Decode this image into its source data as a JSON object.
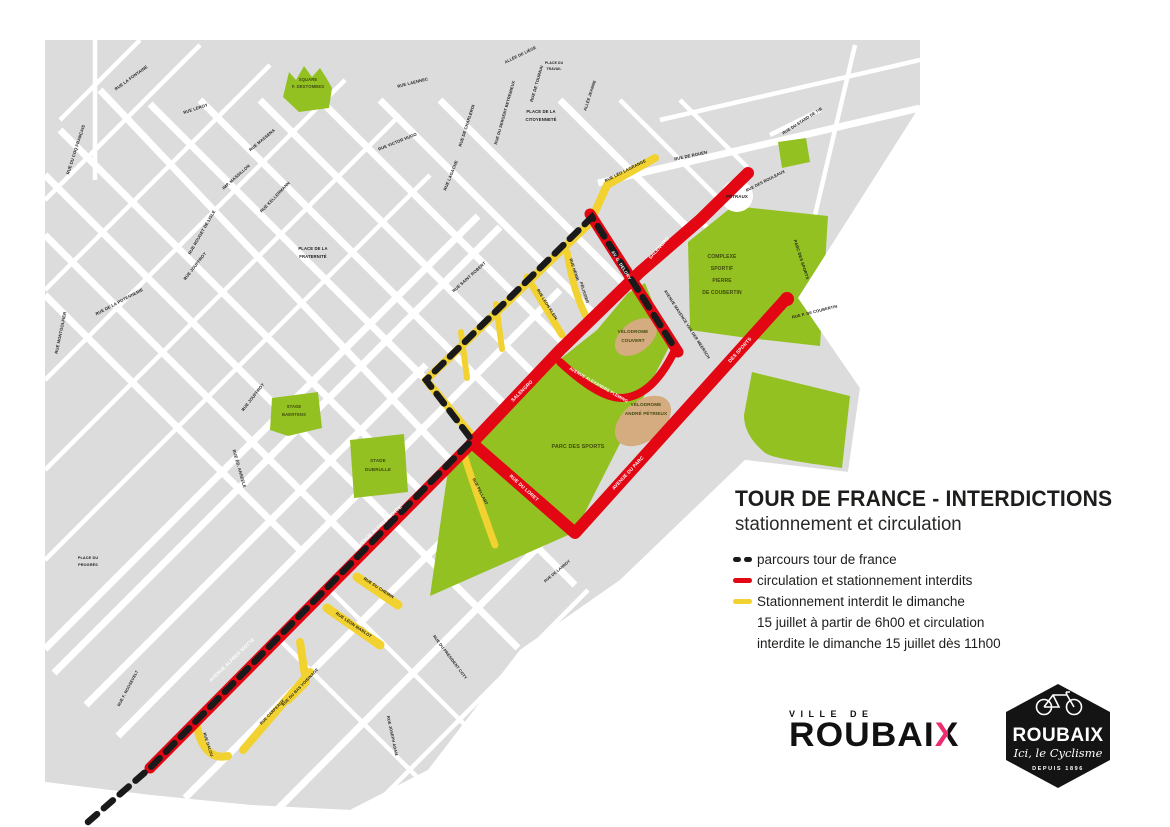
{
  "header": {
    "title": "TOUR DE FRANCE - INTERDICTIONS",
    "subtitle": "stationnement et circulation"
  },
  "legend": {
    "items": [
      {
        "swatch": "dash",
        "label": "parcours tour de france"
      },
      {
        "swatch": "red",
        "label": "circulation et stationnement interdits"
      },
      {
        "swatch": "yellow",
        "lines": [
          "Stationnement interdit le dimanche",
          "15 juillet à partir de 6h00 et circulation",
          "interdite le dimanche 15 juillet dès 11h00"
        ]
      }
    ]
  },
  "logos": {
    "ville": {
      "prefix": "VILLE DE",
      "word": "ROUBAI",
      "x": "X"
    },
    "badge": {
      "name": "ROUBAIX",
      "tagline": "Ici, le Cyclisme",
      "since": "DEPUIS 1896"
    }
  },
  "colors": {
    "red": "#e30613",
    "yellow": "#f2d230",
    "green": "#94c122",
    "tan": "#d5ab80",
    "gray": "#dcdcdc",
    "ink": "#1d1d1b",
    "pink": "#ec2d72",
    "dash": "#1a1a1a"
  },
  "map": {
    "labels": [
      {
        "t": "SQUARE",
        "x": 308,
        "y": 81,
        "r": 0,
        "c": "g",
        "s": 4.2
      },
      {
        "t": "F. DESTOMBES",
        "x": 308,
        "y": 88,
        "r": 0,
        "c": "g",
        "s": 4.2
      },
      {
        "t": "COMPLEXE",
        "x": 722,
        "y": 258,
        "r": 0,
        "c": "g",
        "s": 5
      },
      {
        "t": "SPORTIF",
        "x": 722,
        "y": 270,
        "r": 0,
        "c": "g",
        "s": 5
      },
      {
        "t": "PIERRE",
        "x": 722,
        "y": 282,
        "r": 0,
        "c": "g",
        "s": 5
      },
      {
        "t": "DE COUBERTIN",
        "x": 722,
        "y": 294,
        "r": 0,
        "c": "g",
        "s": 5
      },
      {
        "t": "VÉLODROME",
        "x": 633,
        "y": 333,
        "r": 0,
        "c": "g",
        "s": 4.6
      },
      {
        "t": "COUVERT",
        "x": 633,
        "y": 342,
        "r": 0,
        "c": "g",
        "s": 4.6
      },
      {
        "t": "VÉLODROME",
        "x": 646,
        "y": 406,
        "r": 0,
        "c": "g",
        "s": 4.6
      },
      {
        "t": "ANDRÉ PÉTRIEUX",
        "x": 646,
        "y": 415,
        "r": 0,
        "c": "g",
        "s": 4.6
      },
      {
        "t": "PARC DES SPORTS",
        "x": 578,
        "y": 448,
        "r": 0,
        "c": "g",
        "s": 5.4
      },
      {
        "t": "STADE",
        "x": 294,
        "y": 408,
        "r": 0,
        "c": "g",
        "s": 4.2
      },
      {
        "t": "BAERTENS",
        "x": 294,
        "y": 416,
        "r": 0,
        "c": "g",
        "s": 4.2
      },
      {
        "t": "STADE",
        "x": 378,
        "y": 462,
        "r": 0,
        "c": "g",
        "s": 4.6
      },
      {
        "t": "DUBRULLE",
        "x": 378,
        "y": 471,
        "r": 0,
        "c": "g",
        "s": 4.6
      },
      {
        "t": "PLACE DE LA",
        "x": 541,
        "y": 113,
        "r": 0,
        "c": "k",
        "s": 4.2
      },
      {
        "t": "CITOYENNETÉ",
        "x": 541,
        "y": 121,
        "r": 0,
        "c": "k",
        "s": 4.2
      },
      {
        "t": "PLACE DE LA",
        "x": 313,
        "y": 250,
        "r": 0,
        "c": "k",
        "s": 4.2
      },
      {
        "t": "FRATERNITÉ",
        "x": 313,
        "y": 258,
        "r": 0,
        "c": "k",
        "s": 4.2
      },
      {
        "t": "PLACE DU",
        "x": 88,
        "y": 559,
        "r": 0,
        "c": "k",
        "s": 3.8
      },
      {
        "t": "PROGRÈS",
        "x": 88,
        "y": 566,
        "r": 0,
        "c": "k",
        "s": 3.8
      },
      {
        "t": "PLACE DU",
        "x": 554,
        "y": 64,
        "r": 0,
        "c": "k",
        "s": 3.4
      },
      {
        "t": "TRAVAIL",
        "x": 554,
        "y": 70,
        "r": 0,
        "c": "k",
        "s": 3.4
      },
      {
        "t": "PÉTRAUX",
        "x": 737,
        "y": 198,
        "r": 0,
        "c": "k",
        "s": 4.4
      },
      {
        "t": "AVENUE ALFRED MOTTE",
        "x": 233,
        "y": 661,
        "r": -44,
        "c": "w",
        "s": 4.8
      },
      {
        "t": "AVENUE ALFRED MOTTE",
        "x": 380,
        "y": 528,
        "r": -43,
        "c": "w",
        "s": 4.8
      },
      {
        "t": "SALENGRO",
        "x": 523,
        "y": 392,
        "r": -45,
        "c": "w",
        "s": 4.8
      },
      {
        "t": "SALENGRO",
        "x": 660,
        "y": 249,
        "r": -48,
        "c": "w",
        "s": 4.8
      },
      {
        "t": "AV. G. DELORY",
        "x": 620,
        "y": 266,
        "r": 58,
        "c": "w",
        "s": 4.4
      },
      {
        "t": "RUE DU LORET",
        "x": 523,
        "y": 489,
        "r": 42,
        "c": "w",
        "s": 4.8
      },
      {
        "t": "AVENUE DU PARC",
        "x": 629,
        "y": 474,
        "r": -47,
        "c": "w",
        "s": 4.8
      },
      {
        "t": "DES SPORTS",
        "x": 741,
        "y": 351,
        "r": -48,
        "c": "w",
        "s": 4.8
      },
      {
        "t": "AVENUE ALEXANDRE FLEMING",
        "x": 598,
        "y": 386,
        "r": 30,
        "c": "w",
        "s": 4.2
      },
      {
        "t": "RUE DU COQ FRANÇAIS",
        "x": 77,
        "y": 150,
        "r": -72,
        "c": "k",
        "s": 4.2
      },
      {
        "t": "RUE LA FONTAINE",
        "x": 132,
        "y": 79,
        "r": -36,
        "c": "k",
        "s": 4.2
      },
      {
        "t": "RUE LEROY",
        "x": 196,
        "y": 110,
        "r": -18,
        "c": "k",
        "s": 4.2
      },
      {
        "t": "RUE MASSENA",
        "x": 263,
        "y": 141,
        "r": -40,
        "c": "k",
        "s": 4.2
      },
      {
        "t": "IMP. MASSILLON",
        "x": 237,
        "y": 178,
        "r": -42,
        "c": "k",
        "s": 4.2
      },
      {
        "t": "RUE KELLERMANN",
        "x": 276,
        "y": 198,
        "r": -46,
        "c": "k",
        "s": 4.2
      },
      {
        "t": "RUE ROUGET DE LISLE",
        "x": 203,
        "y": 233,
        "r": -60,
        "c": "k",
        "s": 4.2
      },
      {
        "t": "RUE JOUFFROY",
        "x": 196,
        "y": 267,
        "r": -52,
        "c": "k",
        "s": 4.2
      },
      {
        "t": "RUE JOUFFROY",
        "x": 254,
        "y": 398,
        "r": -52,
        "c": "k",
        "s": 4.2
      },
      {
        "t": "RUE MONTGOLFIER",
        "x": 62,
        "y": 333,
        "r": -78,
        "c": "k",
        "s": 4.2
      },
      {
        "t": "RUE DE LA POTENNERIE",
        "x": 120,
        "y": 303,
        "r": -28,
        "c": "k",
        "s": 4.2
      },
      {
        "t": "RUE VICTOR HUGO",
        "x": 398,
        "y": 143,
        "r": -22,
        "c": "k",
        "s": 4.2
      },
      {
        "t": "RUE LAENNEC",
        "x": 413,
        "y": 84,
        "r": -14,
        "c": "k",
        "s": 4.2
      },
      {
        "t": "RUE DE CHARLEROI",
        "x": 468,
        "y": 126,
        "r": -72,
        "c": "k",
        "s": 4.2
      },
      {
        "t": "RUE DU SERGENT BETREMIEUX",
        "x": 506,
        "y": 113,
        "r": -74,
        "c": "k",
        "s": 4
      },
      {
        "t": "RUE DE TOURNAI",
        "x": 538,
        "y": 84,
        "r": -74,
        "c": "k",
        "s": 4.2
      },
      {
        "t": "ALLÉE DE LIÈGE",
        "x": 521,
        "y": 56,
        "r": -26,
        "c": "k",
        "s": 4
      },
      {
        "t": "ALLÉE JEANNE",
        "x": 591,
        "y": 96,
        "r": -72,
        "c": "k",
        "s": 4
      },
      {
        "t": "RUE LAGACHE",
        "x": 452,
        "y": 176,
        "r": -68,
        "c": "k",
        "s": 4.2
      },
      {
        "t": "RUE SAINT ROBERT",
        "x": 470,
        "y": 278,
        "r": -42,
        "c": "k",
        "s": 4.2
      },
      {
        "t": "RUE HENRI",
        "x": 573,
        "y": 270,
        "r": 72,
        "c": "k",
        "s": 4
      },
      {
        "t": "PÉLISSIER",
        "x": 583,
        "y": 293,
        "r": 72,
        "c": "k",
        "s": 4
      },
      {
        "t": "RUE LÉON KLEIN",
        "x": 546,
        "y": 305,
        "r": 58,
        "c": "k",
        "s": 4
      },
      {
        "t": "RUE LÉO LAGRANGE",
        "x": 626,
        "y": 172,
        "r": -27,
        "c": "k",
        "s": 4.2
      },
      {
        "t": "RUE DE ROUEN",
        "x": 691,
        "y": 157,
        "r": -12,
        "c": "k",
        "s": 4.2
      },
      {
        "t": "AVENUE MAXENCE VAN DER MEERSCH",
        "x": 686,
        "y": 325,
        "r": 57,
        "c": "k",
        "s": 4
      },
      {
        "t": "RUE DU STAND DE TIR",
        "x": 803,
        "y": 122,
        "r": -33,
        "c": "k",
        "s": 4
      },
      {
        "t": "RUE DES BOULEAUX",
        "x": 766,
        "y": 182,
        "r": -27,
        "c": "k",
        "s": 4
      },
      {
        "t": "PARC DES SPORTS",
        "x": 800,
        "y": 260,
        "r": 72,
        "c": "k",
        "s": 4.2
      },
      {
        "t": "RUE P. DE COUBERTIN",
        "x": 815,
        "y": 313,
        "r": -14,
        "c": "k",
        "s": 4
      },
      {
        "t": "RUE ÉD. ANSEELE",
        "x": 238,
        "y": 469,
        "r": 74,
        "c": "k",
        "s": 4.2
      },
      {
        "t": "RUE PELLART",
        "x": 479,
        "y": 492,
        "r": 63,
        "c": "k",
        "s": 4
      },
      {
        "t": "RUE DU CHEMIN",
        "x": 378,
        "y": 589,
        "r": 33,
        "c": "k",
        "s": 4.2
      },
      {
        "t": "RUE LÉON MARLOT",
        "x": 353,
        "y": 626,
        "r": 34,
        "c": "k",
        "s": 4.2
      },
      {
        "t": "RUE DU PRÉSIDENT COTY",
        "x": 449,
        "y": 658,
        "r": 53,
        "c": "k",
        "s": 4
      },
      {
        "t": "RUE JOSEPH ADAM",
        "x": 391,
        "y": 736,
        "r": 78,
        "c": "k",
        "s": 4
      },
      {
        "t": "RUE F. ROOSEVELT",
        "x": 129,
        "y": 689,
        "r": -62,
        "c": "k",
        "s": 4
      },
      {
        "t": "RUE DU BAS VOISINAGE",
        "x": 301,
        "y": 688,
        "r": -46,
        "c": "k",
        "s": 4
      },
      {
        "t": "RUE CARPEAUX",
        "x": 273,
        "y": 713,
        "r": -46,
        "c": "k",
        "s": 4
      },
      {
        "t": "RUE DALOU",
        "x": 207,
        "y": 745,
        "r": 72,
        "c": "k",
        "s": 4
      },
      {
        "t": "RUE DE LANNOY",
        "x": 558,
        "y": 572,
        "r": -40,
        "c": "k",
        "s": 3.8
      }
    ]
  }
}
